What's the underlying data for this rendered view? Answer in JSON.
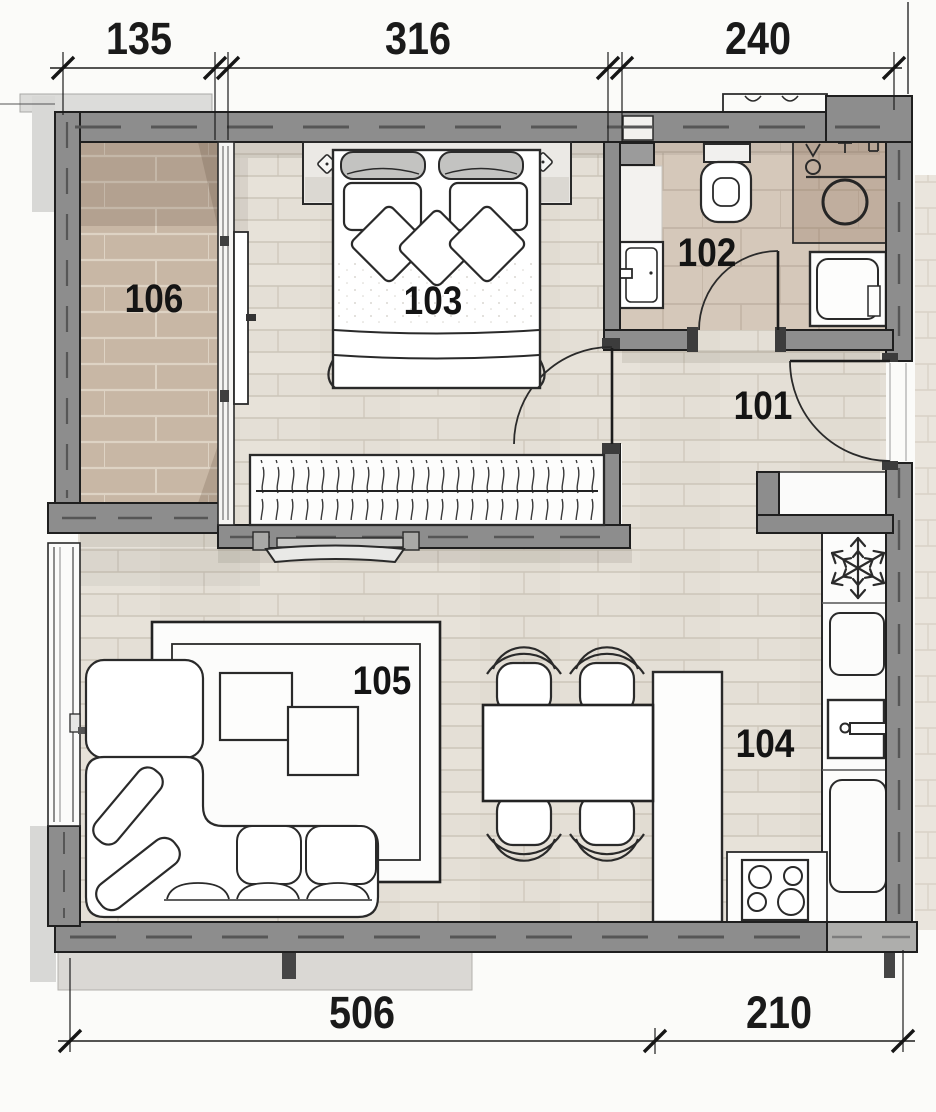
{
  "plan_labels": {
    "hall": "101",
    "bathroom": "102",
    "bedroom": "103",
    "kitchen": "104",
    "living_room": "105",
    "balcony": "106"
  },
  "dimensions": {
    "top": [
      "135",
      "316",
      "240"
    ],
    "bottom": [
      "506",
      "210"
    ]
  },
  "colors": {
    "wall_fill": "#8d8d8d",
    "outline": "#1f1f1f",
    "plank_floor": "#e4dfd6",
    "bath_tile": "#d5c8ba",
    "balcony_tile": "#c8b7a5",
    "counter_tan": "#b49a84",
    "paper": "#fbfbf9"
  },
  "icons": {
    "fridge": "snowflake-icon",
    "washing_machine": "drum-circle-icon",
    "stove": "four-burner-icon",
    "wardrobe": "hanger-rail-icon"
  }
}
